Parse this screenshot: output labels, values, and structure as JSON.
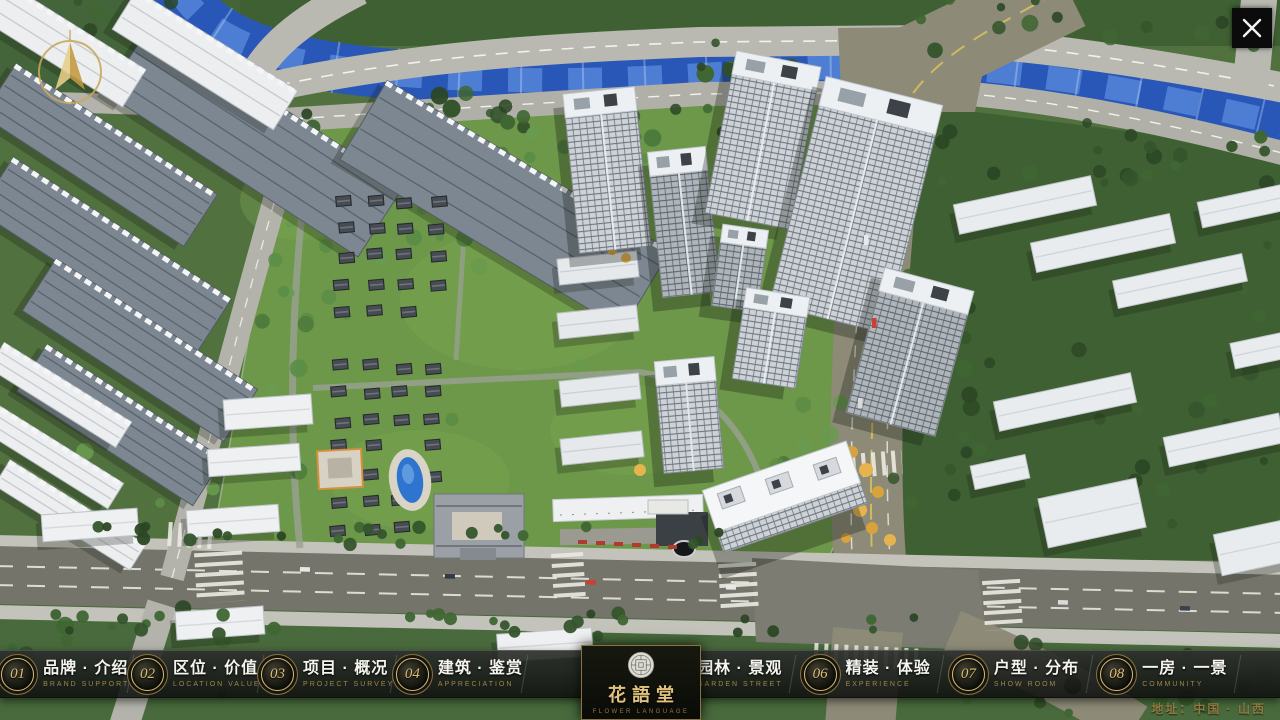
{
  "theme": {
    "gold": "#c9a85f",
    "bar_bg": "#141614",
    "label_white": "#f5f4ee",
    "en_gold": "#9d864d",
    "river_blue": "#2857b8",
    "ground_green": "#51713f"
  },
  "window": {
    "close_icon": "x-close"
  },
  "map": {
    "compass_icon": "north-arrow",
    "address": "地址：中国 · 山西"
  },
  "logo": {
    "seal_icon": "round-seal-emblem",
    "title": "花語堂",
    "subtitle": "FLOWER LANGUAGE"
  },
  "nav": {
    "items": [
      {
        "num": "01",
        "zh": "品牌 · 介绍",
        "en": "BRAND SUPPORT"
      },
      {
        "num": "02",
        "zh": "区位 · 价值",
        "en": "LOCATION VALUE"
      },
      {
        "num": "03",
        "zh": "项目 · 概况",
        "en": "PROJECT SURVEY"
      },
      {
        "num": "04",
        "zh": "建筑 · 鉴赏",
        "en": "APPRECIATION"
      },
      {
        "num": "05",
        "zh": "园林 · 景观",
        "en": "GARDEN STREET"
      },
      {
        "num": "06",
        "zh": "精装 · 体验",
        "en": "EXPERIENCE"
      },
      {
        "num": "07",
        "zh": "户型 · 分布",
        "en": "SHOW ROOM"
      },
      {
        "num": "08",
        "zh": "一房 · 一景",
        "en": "COMMUNITY"
      }
    ]
  }
}
